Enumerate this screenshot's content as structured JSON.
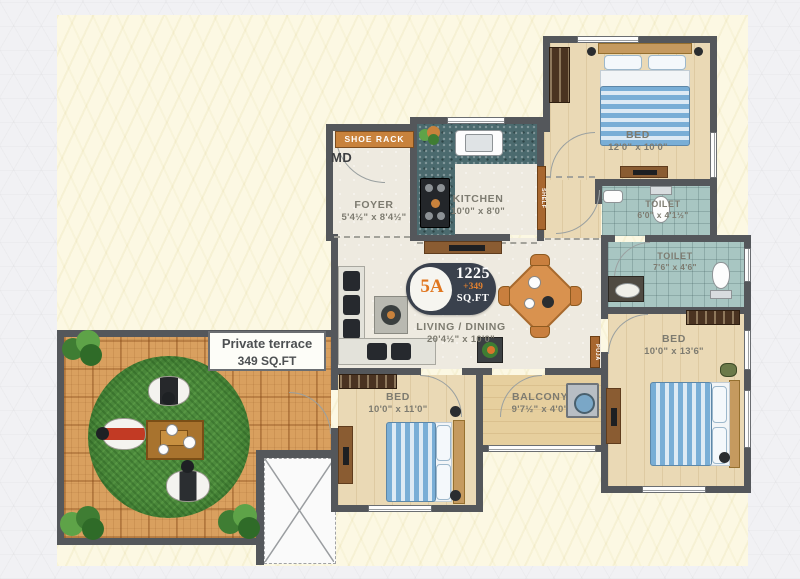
{
  "unit_badge": {
    "unit": "5A",
    "area_main": "1225",
    "area_extra": "+349",
    "area_suffix": "SQ.FT"
  },
  "rooms": {
    "foyer": {
      "name": "FOYER",
      "dim": "5'4½\" x 8'4½\""
    },
    "kitchen": {
      "name": "KITCHEN",
      "dim": "10'0\" x 8'0\""
    },
    "bed1": {
      "name": "BED",
      "dim": "12'0\" x 10'0\""
    },
    "toilet1": {
      "name": "TOILET",
      "dim": "6'0\" x 4'1½\""
    },
    "toilet2": {
      "name": "TOILET",
      "dim": "7'6\" x 4'6\""
    },
    "living": {
      "name": "LIVING / DINING",
      "dim": "20'4½\" x 10'0\""
    },
    "bed2": {
      "name": "BED",
      "dim": "10'0\" x 11'0\""
    },
    "balcony": {
      "name": "BALCONY",
      "dim": "9'7½\" x 4'0\""
    },
    "bed3": {
      "name": "BED",
      "dim": "10'0\" x 13'6\""
    }
  },
  "fixtures": {
    "shoe_rack": "SHOE RACK",
    "main_door": "MD",
    "shelf": "SHELF",
    "puja": "PUJA"
  },
  "terrace": {
    "title": "Private terrace",
    "area": "349 SQ.FT"
  },
  "colors": {
    "wall": "#54575b",
    "accent_orange": "#c8823c",
    "badge_navy": "#3a414d",
    "badge_orange": "#e0761f",
    "grass": "#4c8a3c",
    "terrace_wood": "#d9a05f",
    "toilet_tile": "#a8c6c2",
    "granite": "#4b6a6e",
    "bed_blue": "#79aed6"
  }
}
